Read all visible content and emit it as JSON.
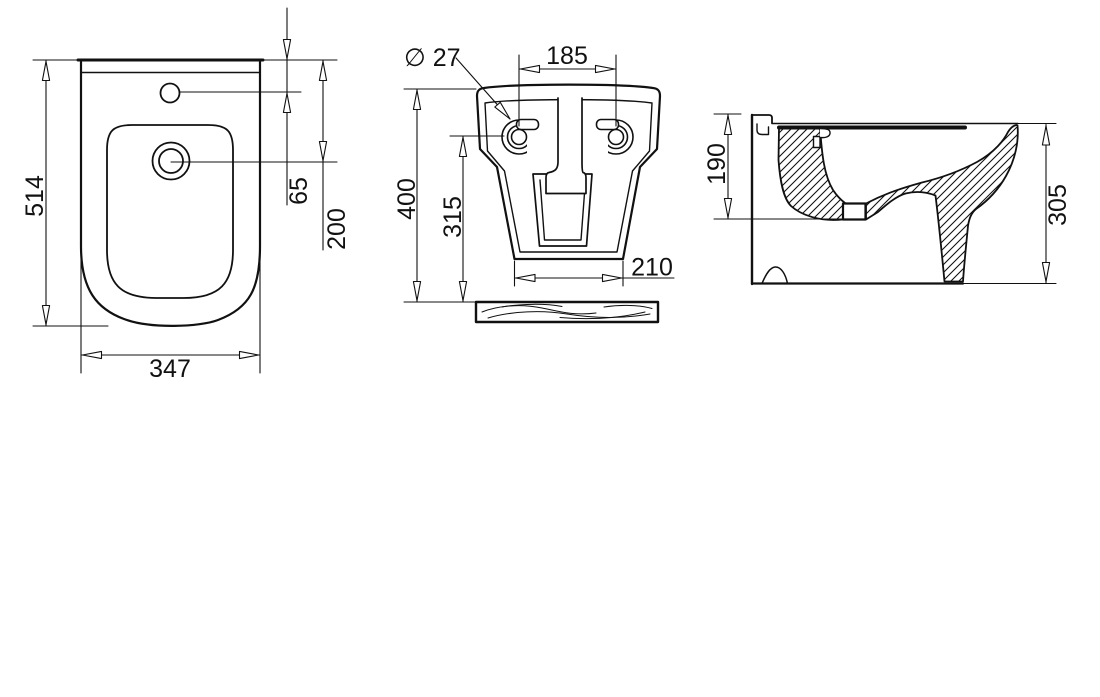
{
  "drawing": {
    "background": "#ffffff",
    "line_color": "#111111",
    "plan_view": {
      "depth": "514",
      "width": "347",
      "tap_hole_offset": "65",
      "drain_offset": "200"
    },
    "rear_view": {
      "hole_diameter": "∅ 27",
      "hole_spacing": "185",
      "height": "400",
      "hole_height": "315",
      "base_width": "210"
    },
    "side_view": {
      "outlet_height": "190",
      "height": "305"
    }
  }
}
